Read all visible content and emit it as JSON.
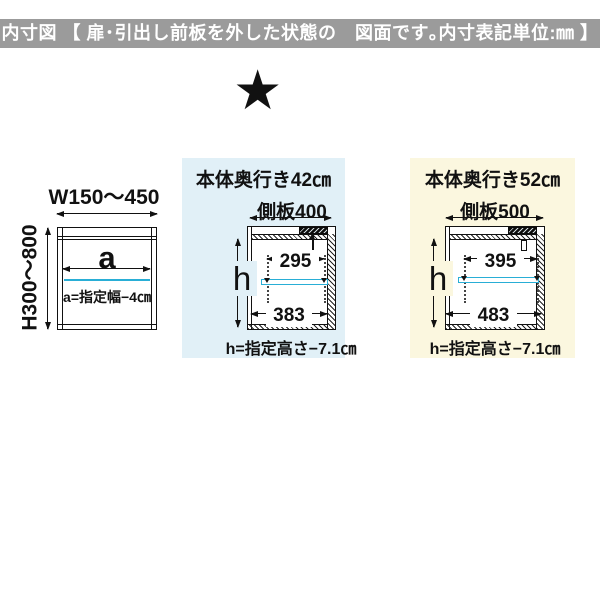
{
  "header": {
    "label": "内寸図 【 扉･引出し前板を外した状態の　図面です｡内寸表記単位:㎜ 】"
  },
  "marker": {
    "star": "★"
  },
  "front_view": {
    "width_range": "W150～450",
    "height_range": "H300～800",
    "inner_width_symbol": "a",
    "inner_width_formula": "a=指定幅−4㎝"
  },
  "depth42": {
    "title": "本体奥行き42㎝",
    "side_panel": "側板400",
    "upper_inner_width": "295",
    "lower_inner_width": "383",
    "height_symbol": "h",
    "height_formula": "h=指定高さ−7.1㎝"
  },
  "depth52": {
    "title": "本体奥行き52㎝",
    "side_panel": "側板500",
    "upper_inner_width": "395",
    "lower_inner_width": "483",
    "height_symbol": "h",
    "height_formula": "h=指定高さ−7.1㎝"
  },
  "colors": {
    "header_bg": "#9b9b9b",
    "panel_blue": "#e1f0f7",
    "panel_yellow": "#fbf7df",
    "shelf_cyan": "#29aed6",
    "line_black": "#111111"
  }
}
